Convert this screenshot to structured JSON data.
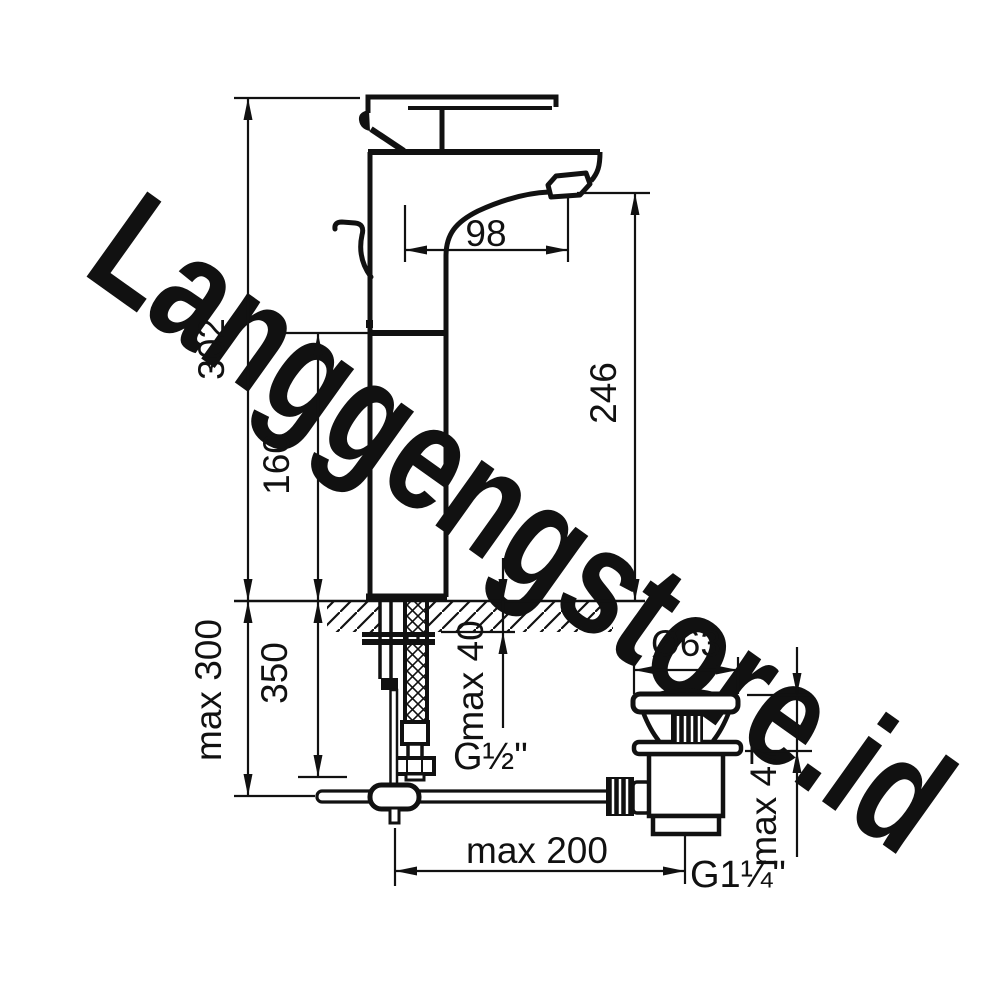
{
  "watermark": {
    "text": "Langgengstore.id",
    "color": "#b2b2b2"
  },
  "diagram": {
    "type": "technical-dimension-drawing",
    "subject": "single-lever tall basin mixer tap with pop-up waste drain",
    "units": "mm",
    "line_color": "#111111",
    "dims": {
      "overall_height": "302",
      "body_height": "160",
      "outlet_height": "246",
      "spout_reach": "98",
      "max_below_deck": "max 300",
      "hose_length": "350",
      "max_deck_faucet": "max 40",
      "supply_thread": "G½\"",
      "waste_diameter": "Ø63",
      "max_deck_waste": "max 47",
      "rod_reach": "max 200",
      "waste_thread": "G1¼\""
    }
  }
}
